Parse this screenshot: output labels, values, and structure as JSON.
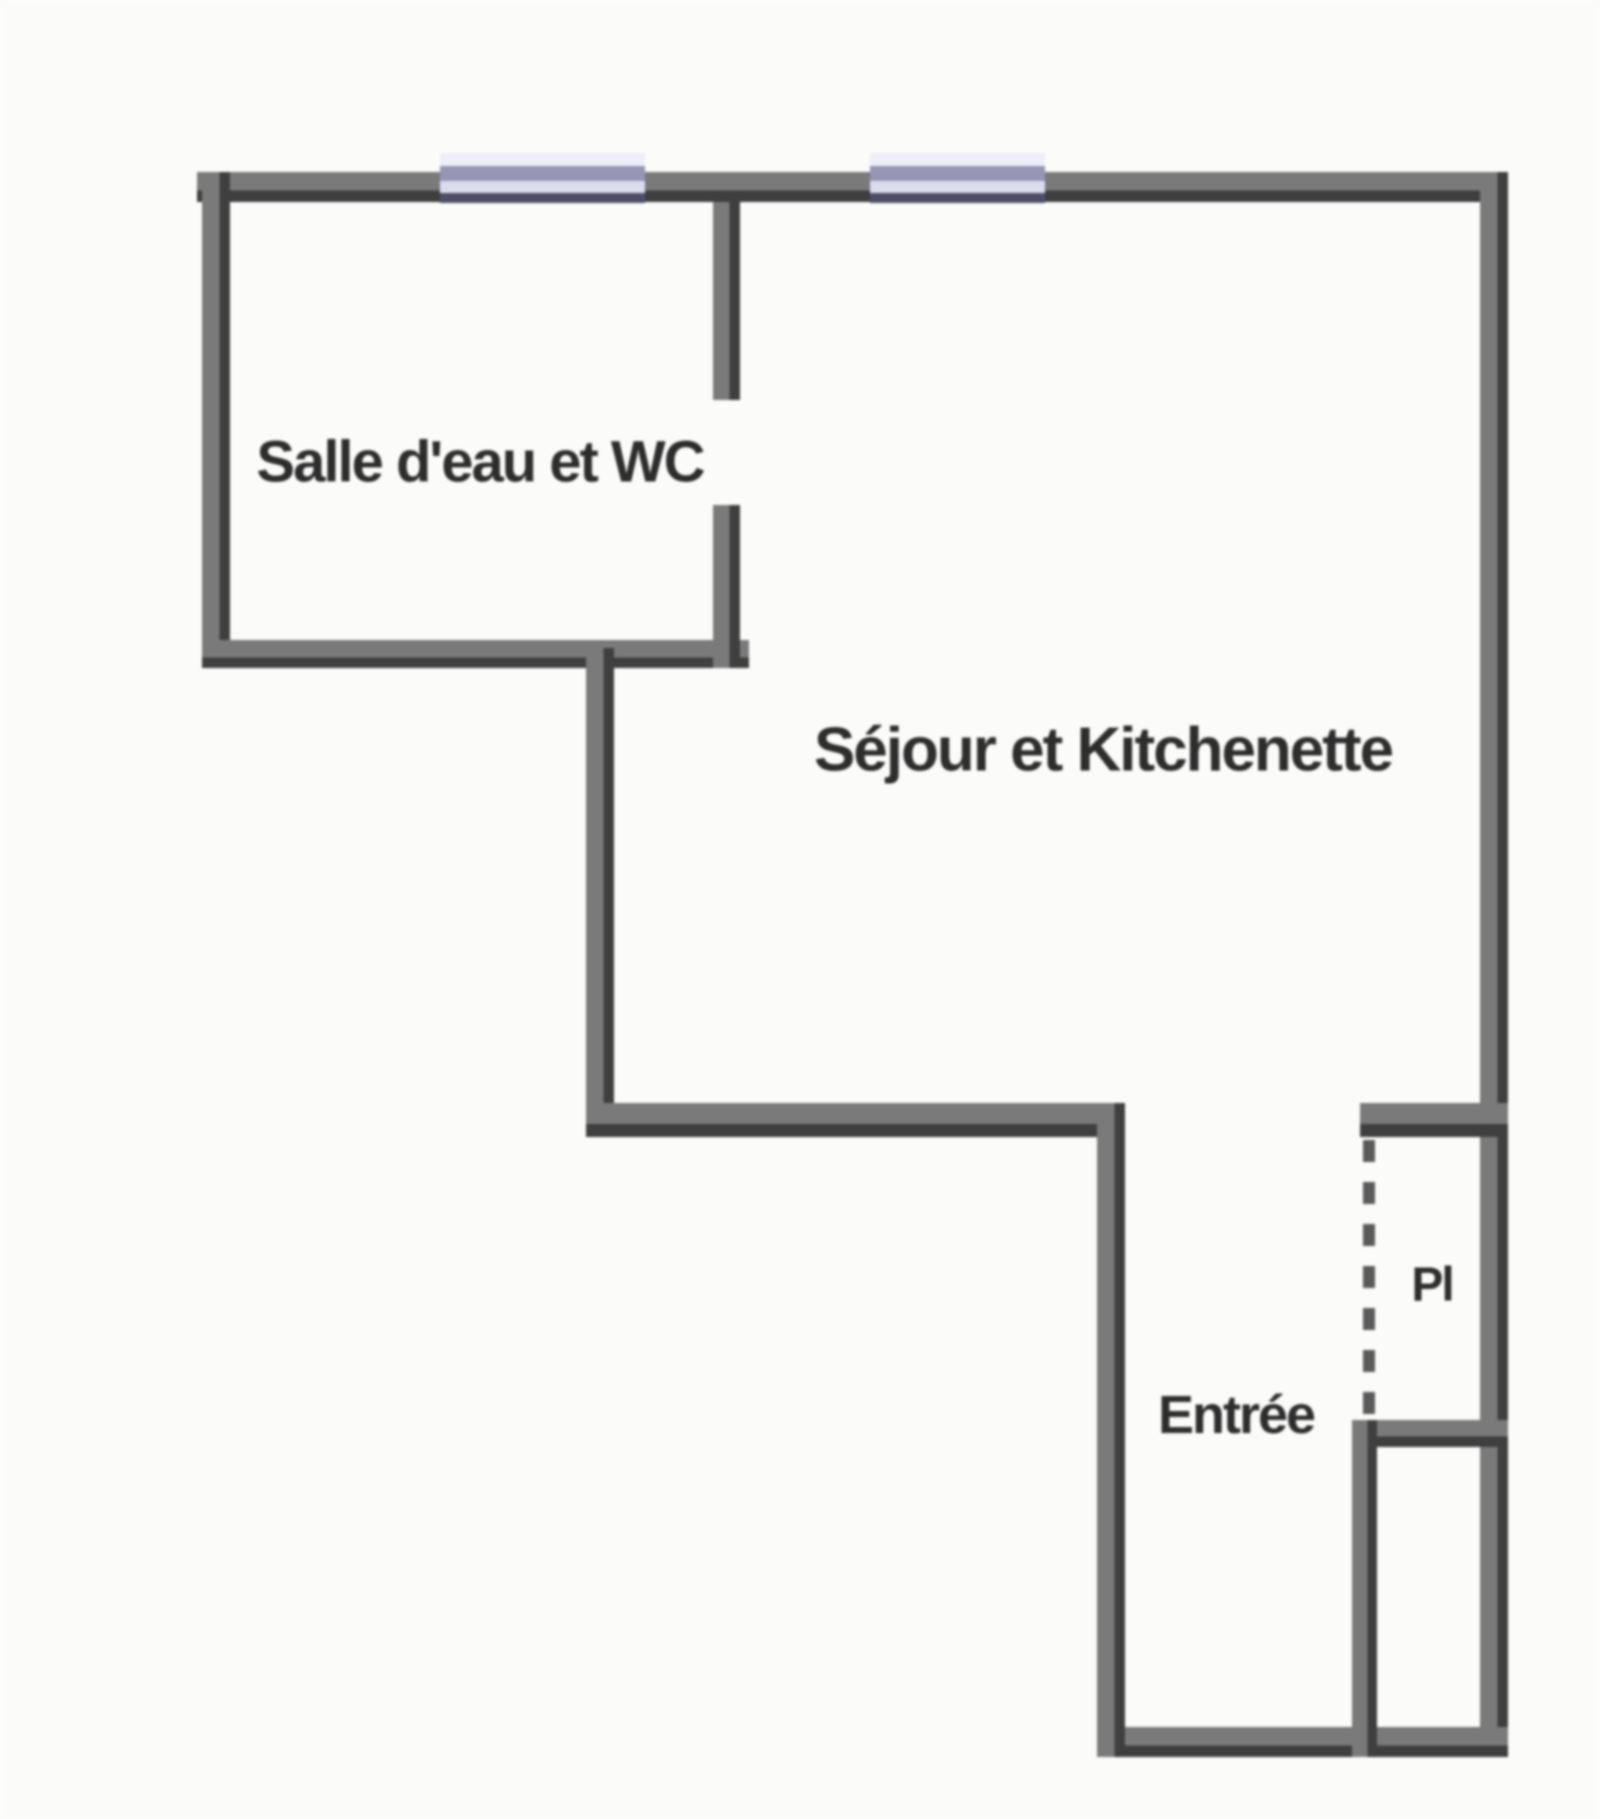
{
  "plan": {
    "rooms": [
      {
        "id": "bathroom",
        "label": "Salle d'eau et WC"
      },
      {
        "id": "living",
        "label": "Séjour et Kitchenette"
      },
      {
        "id": "hall",
        "label": "Entrée"
      },
      {
        "id": "closet",
        "label": "Pl"
      }
    ],
    "colors": {
      "background": "#fbfbf9",
      "wall_gray": "#7a7a7a",
      "wall_dark": "#3f3f3f",
      "window_pale": "#eeeef8",
      "window_mid": "#9696b4",
      "window_light": "#dcdcf0",
      "window_dark": "#4e4e66",
      "dash": "#5a5a5a",
      "text": "#2d2d2d"
    }
  }
}
